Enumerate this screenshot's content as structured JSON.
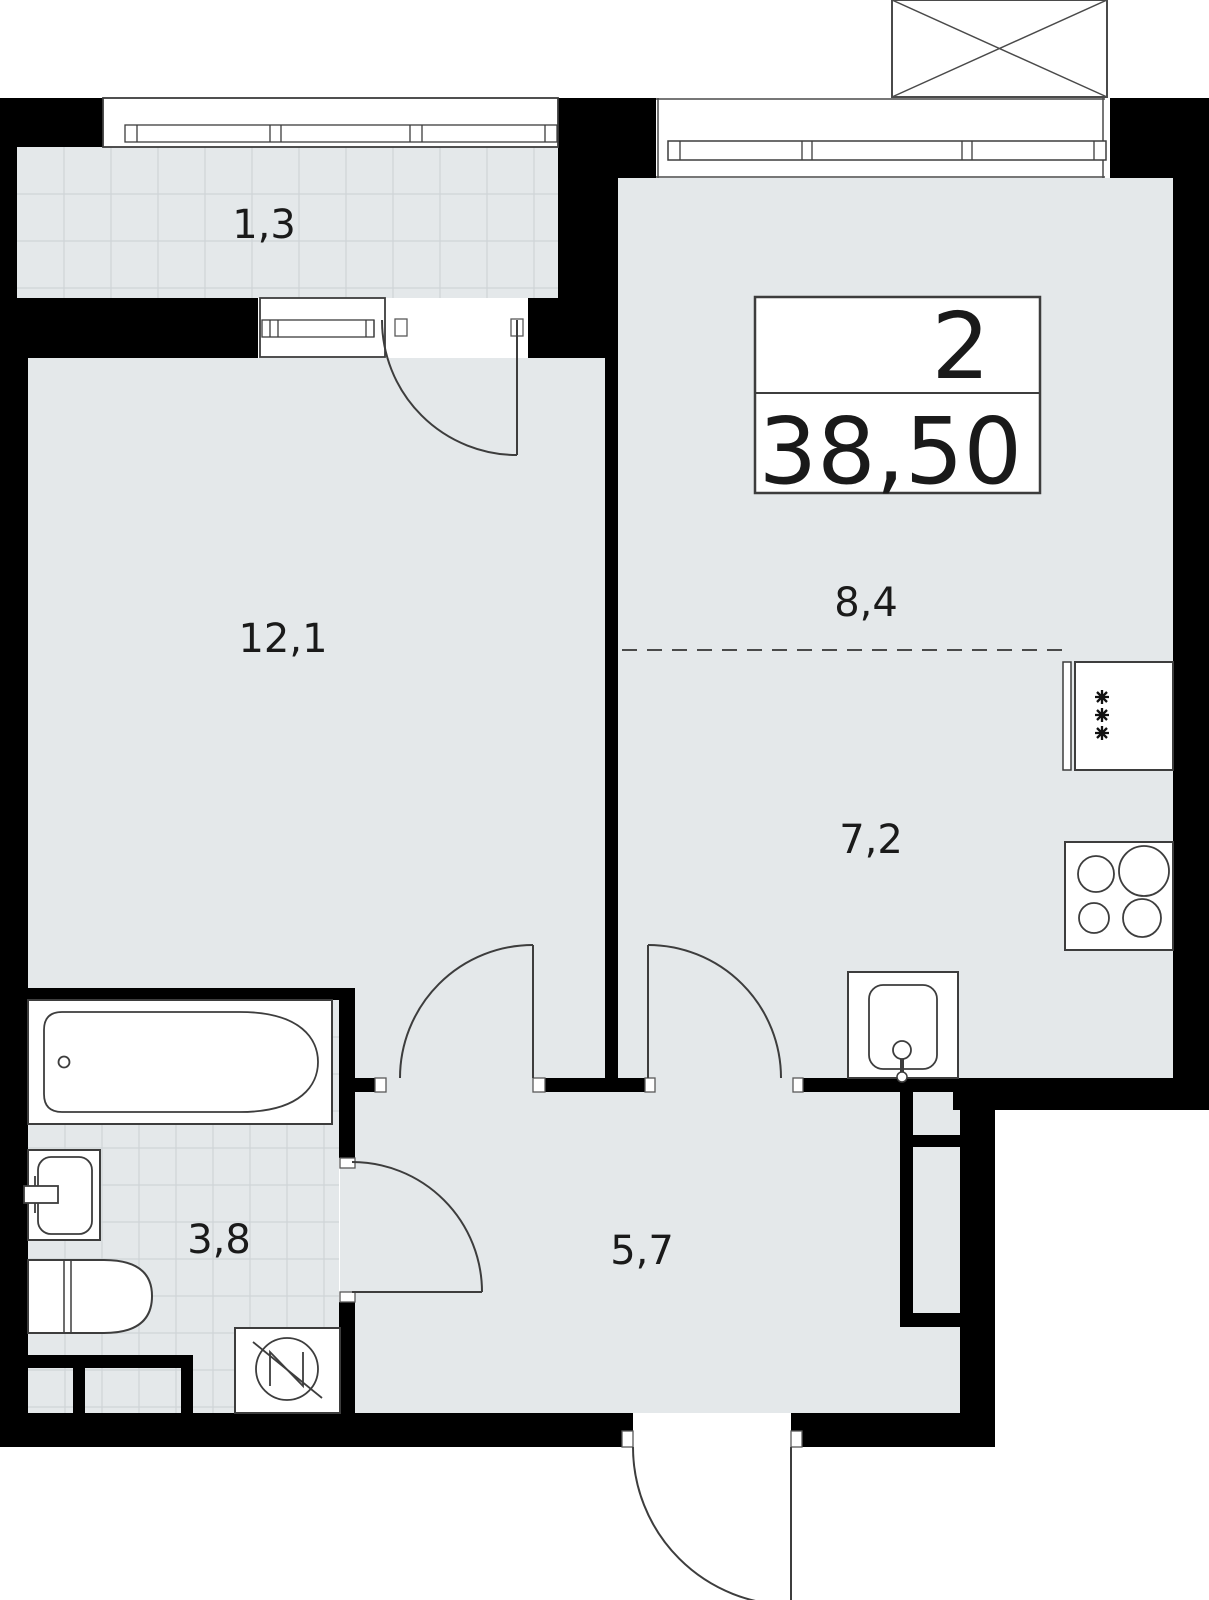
{
  "plan": {
    "type": "apartment-floor-plan",
    "title_block": {
      "rooms_count": "2",
      "total_area": "38,50"
    },
    "rooms": [
      {
        "id": "balcony",
        "area_label": "1,3"
      },
      {
        "id": "living-room",
        "area_label": "12,1"
      },
      {
        "id": "kitchen-dining-zone",
        "area_label": "8,4"
      },
      {
        "id": "kitchen-zone",
        "area_label": "7,2"
      },
      {
        "id": "bathroom",
        "area_label": "3,8"
      },
      {
        "id": "hallway",
        "area_label": "5,7"
      }
    ],
    "fixtures": [
      "bathtub",
      "washbasin",
      "toilet",
      "washing-machine",
      "kitchen-sink",
      "cooktop",
      "refrigerator",
      "ac-unit-box"
    ],
    "colors": {
      "wall": "#000000",
      "floor": "#e4e8ea",
      "outline": "#3d3d3d",
      "background": "#ffffff"
    }
  }
}
